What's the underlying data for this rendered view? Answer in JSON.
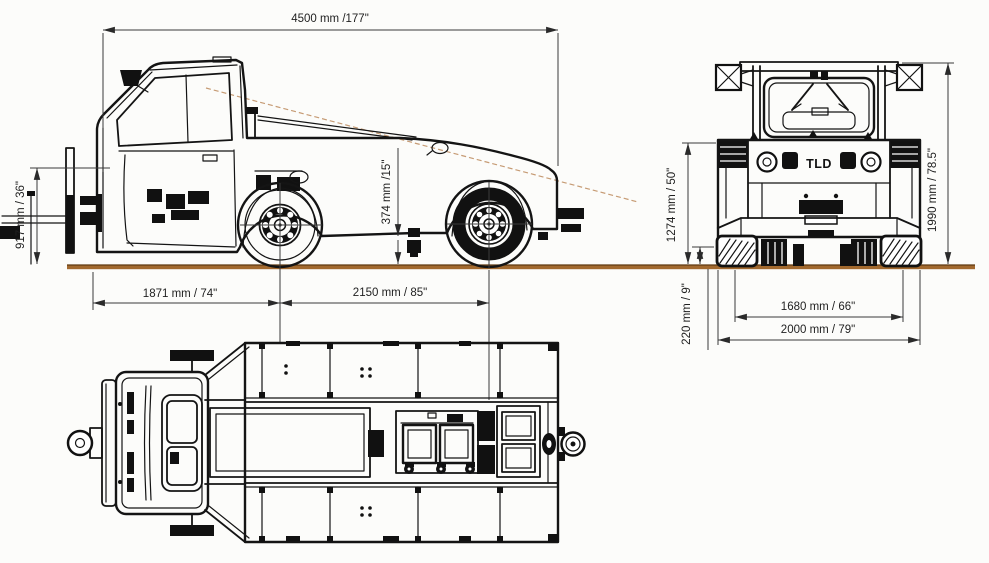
{
  "branding": {
    "logo": "TLD"
  },
  "side_view": {
    "overall_length": "4500 mm /177\"",
    "coupling_height": "917 mm / 36\"",
    "ground_clearance": "374 mm /15\"",
    "front_axle_distance": "1871 mm / 74\"",
    "wheelbase": "2150 mm / 85\""
  },
  "front_view": {
    "hood_height": "1274 mm / 50\"",
    "overall_height": "1990 mm / 78.5\"",
    "bumper_clearance": "220 mm / 9\"",
    "track_width": "1680 mm / 66\"",
    "overall_width": "2000 mm / 79\""
  },
  "colors": {
    "ground": "#a2692e",
    "ground_edge": "#5f3a12",
    "sight_line": "#c69b74",
    "line_art": "#141414",
    "dimension_text": "#1f1f1f",
    "background": "#fcfcfa"
  }
}
